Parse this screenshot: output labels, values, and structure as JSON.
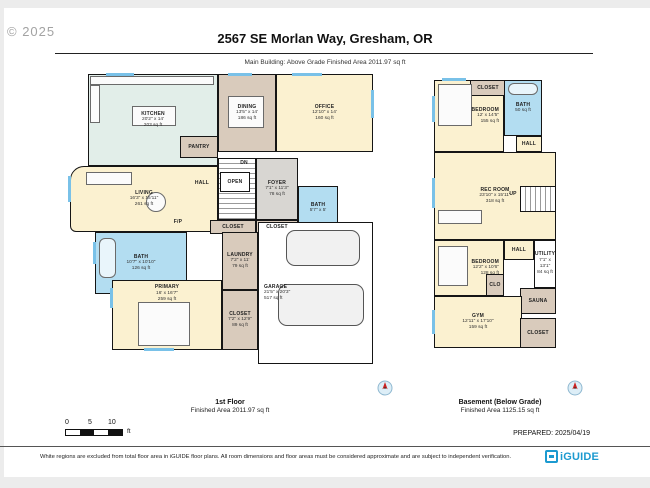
{
  "header": {
    "copyright": "© 2025",
    "title": "2567 SE Morlan Way, Gresham, OR",
    "subtitle": "Main Building: Above Grade Finished Area 2011.97 sq ft"
  },
  "captions": {
    "first_floor": {
      "name": "1st Floor",
      "area": "Finished Area 2011.97 sq ft"
    },
    "basement": {
      "name": "Basement (Below Grade)",
      "area": "Finished Area 1125.15 sq ft"
    }
  },
  "scale_bar": {
    "labels": [
      "0",
      "5",
      "10"
    ],
    "unit": "ft"
  },
  "prepared": "PREPARED: 2025/04/19",
  "footer": {
    "disclaimer": "White regions are excluded from total floor area in iGUIDE floor plans. All room dimensions and floor areas must be considered approximate and are subject to independent verification.",
    "logo": "iGUIDE"
  },
  "colors": {
    "yellow": "#fbf1d0",
    "tan": "#d9cbbc",
    "mint": "#e2eee9",
    "blue": "#b3ddf1",
    "gray": "#d8d6d2",
    "white": "#ffffff",
    "wall": "#151515",
    "window": "#79c1e8",
    "brand_blue": "#1c9ad0",
    "compass_red": "#cc2222"
  },
  "floors": [
    {
      "id": "plan-first-floor",
      "rooms": [
        {
          "key": "kitchen",
          "name": "KITCHEN",
          "dims": "20'2\" x 14'",
          "area": "203 sq ft",
          "rect": [
            28,
            0,
            130,
            92
          ],
          "fill": "mint"
        },
        {
          "key": "dining",
          "name": "DINING",
          "dims": "13'5\" x 14'",
          "area": "186 sq ft",
          "rect": [
            158,
            0,
            58,
            78
          ],
          "fill": "tan"
        },
        {
          "key": "office",
          "name": "OFFICE",
          "dims": "12'10\" x 14'",
          "area": "160 sq ft",
          "rect": [
            216,
            0,
            97,
            78
          ],
          "fill": "yellow"
        },
        {
          "key": "living",
          "name": "LIVING",
          "dims": "16'3\" x 15'11\"",
          "area": "261 sq ft",
          "rect": [
            10,
            92,
            148,
            66
          ],
          "fill": "yellow",
          "round": true
        },
        {
          "key": "pantry",
          "name": "PANTRY",
          "rect": [
            120,
            62,
            38,
            22
          ],
          "fill": "tan"
        },
        {
          "key": "stairwell",
          "rect": [
            158,
            84,
            38,
            62
          ],
          "fill": "white",
          "stairs": "h"
        },
        {
          "key": "open-stair",
          "name": "OPEN",
          "rect": [
            160,
            98,
            30,
            20
          ],
          "fill": "white"
        },
        {
          "key": "foyer",
          "name": "FOYER",
          "dims": "7'1\" x 11'3\"",
          "area": "78 sq ft",
          "rect": [
            196,
            84,
            42,
            62
          ],
          "fill": "gray"
        },
        {
          "key": "bath-powder",
          "name": "BATH",
          "dims": "5'7\" x 5'",
          "rect": [
            238,
            112,
            40,
            44
          ],
          "fill": "blue"
        },
        {
          "key": "closet-hall-a",
          "name": "CLOSET",
          "rect": [
            150,
            146,
            46,
            14
          ],
          "fill": "tan"
        },
        {
          "key": "closet-hall-b",
          "name": "CLOSET",
          "rect": [
            196,
            146,
            42,
            14
          ],
          "fill": "tan"
        },
        {
          "key": "bath-primary",
          "name": "BATH",
          "dims": "10'7\" x 10'10\"",
          "area": "126 sq ft",
          "rect": [
            35,
            158,
            92,
            62
          ],
          "fill": "blue"
        },
        {
          "key": "laundry",
          "name": "LAUNDRY",
          "dims": "7'2\" x 11'",
          "area": "79 sq ft",
          "rect": [
            162,
            158,
            36,
            58
          ],
          "fill": "tan"
        },
        {
          "key": "primary",
          "name": "PRIMARY",
          "dims": "16' x 16'7\"",
          "area": "259 sq ft",
          "rect": [
            52,
            206,
            110,
            70
          ],
          "fill": "yellow",
          "label_pos": "top"
        },
        {
          "key": "closet-primary",
          "name": "CLOSET",
          "dims": "7'2\" x 12'9\"",
          "area": "89 sq ft",
          "rect": [
            162,
            216,
            36,
            60
          ],
          "fill": "tan"
        },
        {
          "key": "garage",
          "name": "GARAGE",
          "dims": "21'5\" x 20'3\"",
          "area": "517 sq ft",
          "rect": [
            198,
            148,
            115,
            142
          ],
          "fill": "white",
          "label_pos": "left"
        },
        {
          "key": "hall",
          "name": "HALL",
          "rect": [
            128,
            104,
            28,
            10
          ],
          "text_only": true
        },
        {
          "key": "dn",
          "name": "DN",
          "rect": [
            174,
            85,
            20,
            9
          ],
          "text_only": true
        },
        {
          "key": "fireplace",
          "name": "F/P",
          "rect": [
            108,
            144,
            20,
            9
          ],
          "text_only": true
        }
      ],
      "details": [
        {
          "type": "counter",
          "rect": [
            30,
            2,
            124,
            9
          ]
        },
        {
          "type": "counter",
          "rect": [
            30,
            11,
            10,
            38
          ]
        },
        {
          "type": "island",
          "rect": [
            72,
            32,
            44,
            20
          ]
        },
        {
          "type": "table",
          "rect": [
            168,
            22,
            36,
            32
          ]
        },
        {
          "type": "sofa",
          "rect": [
            26,
            98,
            46,
            13
          ]
        },
        {
          "type": "round-table",
          "rect": [
            86,
            118,
            20,
            20
          ]
        },
        {
          "type": "tub",
          "rect": [
            39,
            164,
            17,
            40
          ]
        },
        {
          "type": "bed",
          "rect": [
            78,
            228,
            52,
            44
          ]
        },
        {
          "type": "car",
          "rect": [
            226,
            156,
            74,
            36
          ]
        },
        {
          "type": "car",
          "rect": [
            218,
            210,
            86,
            42
          ]
        },
        {
          "type": "window-h",
          "rect": [
            46,
            -1,
            28,
            3
          ]
        },
        {
          "type": "window-h",
          "rect": [
            168,
            -1,
            24,
            3
          ]
        },
        {
          "type": "window-h",
          "rect": [
            232,
            -1,
            30,
            3
          ]
        },
        {
          "type": "window-v",
          "rect": [
            311,
            16,
            3,
            28
          ]
        },
        {
          "type": "window-v",
          "rect": [
            8,
            102,
            3,
            26
          ]
        },
        {
          "type": "window-v",
          "rect": [
            33,
            168,
            3,
            22
          ]
        },
        {
          "type": "window-h",
          "rect": [
            84,
            274,
            30,
            3
          ]
        },
        {
          "type": "window-v",
          "rect": [
            50,
            214,
            3,
            20
          ]
        }
      ]
    },
    {
      "id": "plan-basement",
      "rooms": [
        {
          "key": "bedroom-upper",
          "name": "BEDROOM",
          "dims": "12' x 14'5\"",
          "area": "155 sq ft",
          "rect": [
            2,
            2,
            70,
            72
          ],
          "fill": "yellow",
          "label_pos": "right"
        },
        {
          "key": "closet-upper",
          "name": "CLOSET",
          "rect": [
            38,
            2,
            36,
            16
          ],
          "fill": "tan"
        },
        {
          "key": "bath-basement",
          "name": "BATH",
          "area": "50 sq ft",
          "rect": [
            72,
            2,
            38,
            56
          ],
          "fill": "blue"
        },
        {
          "key": "hall-upper",
          "name": "HALL",
          "rect": [
            84,
            58,
            26,
            16
          ],
          "fill": "yellow"
        },
        {
          "key": "rec-room",
          "name": "REC ROOM",
          "dims": "23'10\" x 15'11\"",
          "area": "318 sq ft",
          "rect": [
            2,
            74,
            122,
            88
          ],
          "fill": "yellow"
        },
        {
          "key": "stairs-up",
          "rect": [
            88,
            108,
            36,
            26
          ],
          "fill": "white",
          "stairs": "v"
        },
        {
          "key": "up",
          "name": "UP",
          "rect": [
            74,
            112,
            14,
            9
          ],
          "text_only": true
        },
        {
          "key": "hall-mid",
          "name": "HALL",
          "rect": [
            72,
            162,
            30,
            20
          ],
          "fill": "yellow"
        },
        {
          "key": "utility",
          "name": "UTILITY",
          "dims": "7'1\" x 13'1\"",
          "area": "84 sq ft",
          "rect": [
            102,
            162,
            22,
            48
          ],
          "fill": "white"
        },
        {
          "key": "bedroom-lower",
          "name": "BEDROOM",
          "dims": "12'2\" x 10'6\"",
          "area": "128 sq ft",
          "rect": [
            2,
            162,
            70,
            56
          ],
          "fill": "yellow",
          "label_pos": "right"
        },
        {
          "key": "clo",
          "name": "CLO",
          "rect": [
            54,
            196,
            18,
            22
          ],
          "fill": "tan"
        },
        {
          "key": "sauna",
          "name": "SAUNA",
          "rect": [
            88,
            210,
            36,
            26
          ],
          "fill": "tan"
        },
        {
          "key": "gym",
          "name": "GYM",
          "dims": "12'11\" x 17'10\"",
          "area": "159 sq ft",
          "rect": [
            2,
            218,
            88,
            52
          ],
          "fill": "yellow"
        },
        {
          "key": "closet-basement",
          "name": "CLOSET",
          "rect": [
            88,
            240,
            36,
            30
          ],
          "fill": "tan"
        }
      ],
      "details": [
        {
          "type": "bed",
          "rect": [
            6,
            6,
            34,
            42
          ]
        },
        {
          "type": "tub",
          "rect": [
            76,
            5,
            30,
            12
          ]
        },
        {
          "type": "sofa",
          "rect": [
            6,
            132,
            44,
            14
          ]
        },
        {
          "type": "bed",
          "rect": [
            6,
            168,
            30,
            40
          ]
        },
        {
          "type": "window-v",
          "rect": [
            0,
            18,
            3,
            26
          ]
        },
        {
          "type": "window-v",
          "rect": [
            0,
            100,
            3,
            30
          ]
        },
        {
          "type": "window-v",
          "rect": [
            0,
            232,
            3,
            24
          ]
        },
        {
          "type": "window-h",
          "rect": [
            10,
            0,
            24,
            3
          ]
        }
      ]
    }
  ]
}
